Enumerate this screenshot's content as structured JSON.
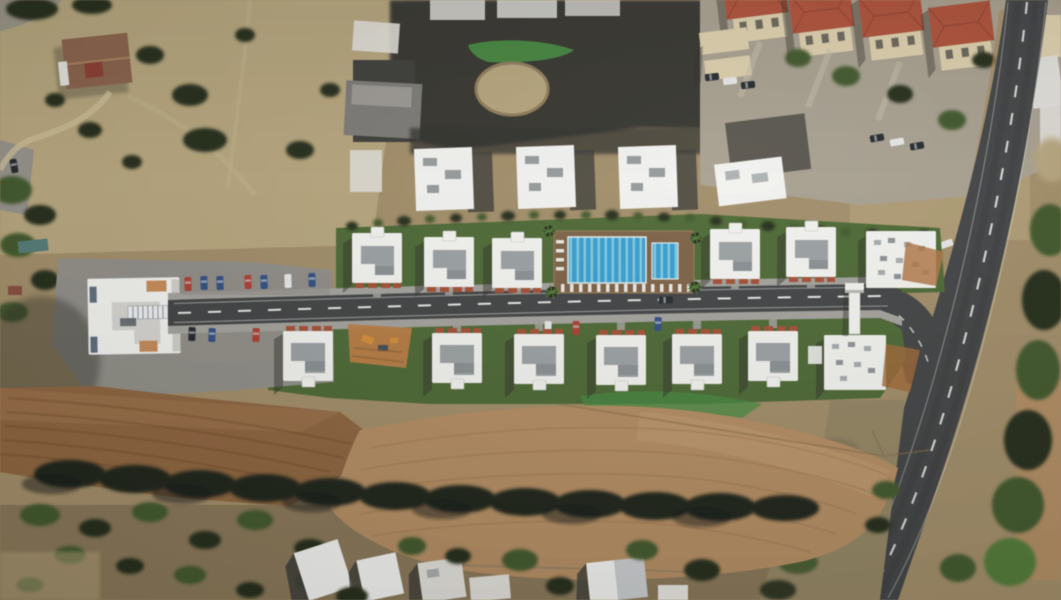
{
  "meta": {
    "title": "Aerial drone render of a villa development site plan with pool, internal road, surrounding fields and neighbourhood",
    "image_type": "aerial-photograph-render",
    "width_px": 1061,
    "height_px": 600
  },
  "colors": {
    "dirt_light": "#b7a478",
    "dirt_mid": "#a28c63",
    "dirt_dark": "#6e5d43",
    "field_brown": "#8f6239",
    "field_brown_dark": "#6b421f",
    "field_tan": "#b68c5c",
    "field_tan_light": "#c79e6c",
    "tree_dark": "#222b18",
    "tree_green": "#3c5626",
    "tree_bright": "#4e7a30",
    "lawn": "#49682e",
    "lawn_bright": "#3f8a38",
    "asphalt": "#3f4142",
    "sidewalk": "#a3a19b",
    "pavement": "#8f8d86",
    "concrete_shadow": "#5c584e",
    "building_white": "#f3f3f0",
    "building_offwhite": "#e2e0d9",
    "roof_gray": "#9aa0a3",
    "roof_gray_dark": "#7c8285",
    "roof_red": "#b44d33",
    "roof_red_dark": "#8f3a26",
    "facade_cream": "#dfd0a9",
    "house_roof": "#8a5f46",
    "deck_brown": "#7d5f41",
    "pool_blue": "#2f9fd4",
    "pool_blue_light": "#79cde8",
    "planter_red": "#a84c2e",
    "construction_orange": "#c07a3c",
    "pergola": "#c98a50",
    "shadow": "#2c2a24",
    "road_line": "#e9e9e6",
    "car_red": "#b23b2e",
    "car_blue": "#2e4d86",
    "car_white": "#e8e8e6",
    "car_dark": "#23272b",
    "car_teal": "#4e7a74"
  },
  "scene": {
    "development": {
      "name": "new-villa-estate",
      "north_villa_count": 5,
      "south_villa_count": 6,
      "large_blocks": [
        "west-apartment-building",
        "east-apartment-block",
        "east-south-villa"
      ],
      "pool": {
        "pools": 2,
        "deck": "timber",
        "sun_loungers": 19,
        "lap_lanes": 10
      },
      "water_tower_count": 1,
      "internal_road": {
        "surface": "asphalt",
        "center_line": "white-dashed",
        "sidewalks": true,
        "parked_cars": 14
      },
      "landscaping": [
        "lawns",
        "hedge-rows",
        "palm-trees"
      ],
      "construction_patch": {
        "equipment_visible": true
      }
    },
    "surroundings": {
      "north_east_neighborhood": {
        "red_roof_villas": 4,
        "cream_row_houses": 2,
        "parking_cars": 6
      },
      "construction_blocks_north": 3,
      "existing_house_north_west": 1,
      "main_road": {
        "orientation": "NE-SW-diagonal",
        "center_line": "white-dashed",
        "cars": 2
      },
      "fields": [
        "plowed-brown-field-south-west",
        "harvested-tan-field-south"
      ],
      "tree_line_count": 1,
      "south_edge_buildings": 5
    }
  }
}
